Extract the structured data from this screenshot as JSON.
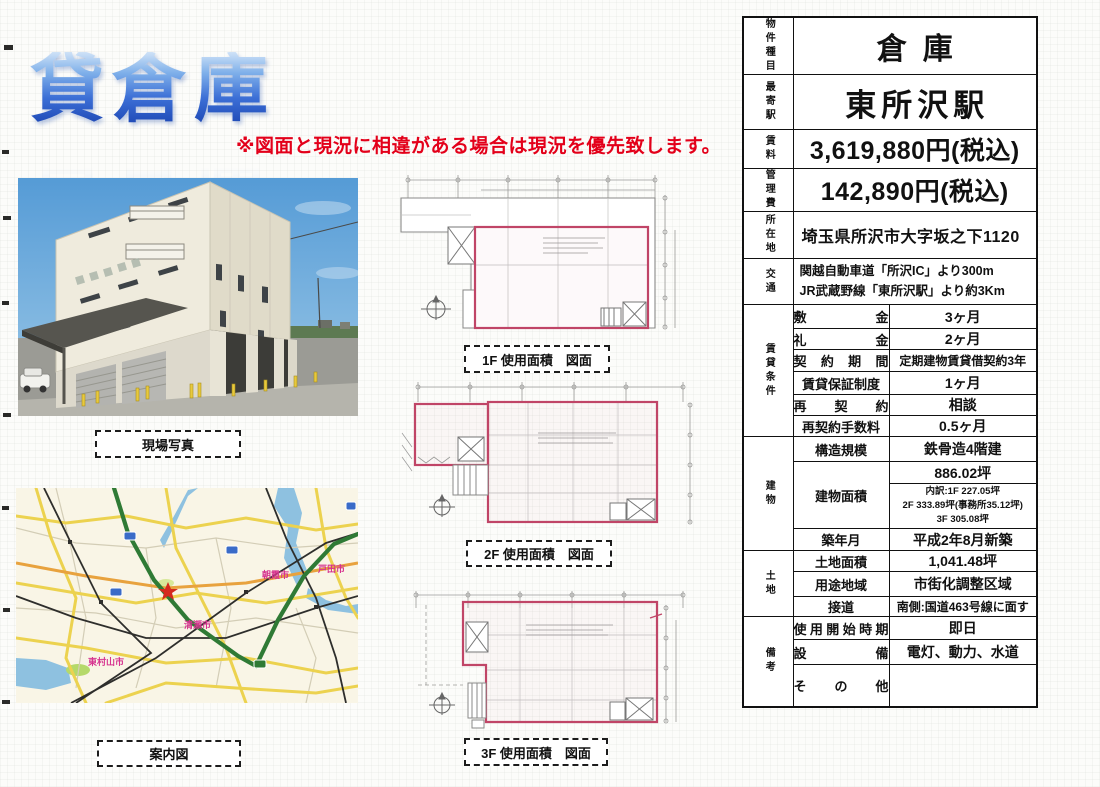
{
  "header": {
    "title": "貸倉庫",
    "disclaimer": "※図面と現況に相違がある場合は現況を優先致します。"
  },
  "captions": {
    "photo": "現場写真",
    "map": "案内図",
    "plan1": "1F 使用面積　図面",
    "plan2": "2F 使用面積　図面",
    "plan3": "3F 使用面積　図面"
  },
  "map_labels": {
    "kiyose": "清瀬市",
    "higashimurayama": "東村山市",
    "asaka": "朝霞市",
    "toda": "戸田市"
  },
  "property_table": {
    "simple_rows": [
      {
        "category": "物件種目",
        "value": "倉庫"
      },
      {
        "category": "最寄駅",
        "value": "東所沢駅"
      },
      {
        "category": "賃料",
        "value": "3,619,880円(税込)"
      },
      {
        "category": "管理費",
        "value": "142,890円(税込)"
      },
      {
        "category": "所在地",
        "value": "埼玉県所沢市大字坂之下1120"
      },
      {
        "category": "交通",
        "value": "関越自動車道「所沢IC」より300m\nJR武蔵野線「東所沢駅」より約3Km"
      }
    ],
    "groups": [
      {
        "category": "賃貸条件",
        "rows": [
          {
            "label": "敷 金",
            "value": "3ヶ月"
          },
          {
            "label": "礼 金",
            "value": "2ヶ月"
          },
          {
            "label": "契 約 期 間",
            "value": "定期建物賃貸借契約3年"
          },
          {
            "label": "賃貸保証制度",
            "value": "1ヶ月"
          },
          {
            "label": "再 契 約",
            "value": "相談"
          },
          {
            "label": "再契約手数料",
            "value": "0.5ヶ月"
          }
        ]
      },
      {
        "category": "建物",
        "rows": [
          {
            "label": "構造規模",
            "value": "鉄骨造4階建"
          },
          {
            "label": "建物面積",
            "value": "886.02坪",
            "sub_value": "内訳:1F 227.05坪\n2F 333.89坪(事務所35.12坪)\n3F 305.08坪"
          },
          {
            "label": "築年月",
            "value": "平成2年8月新築"
          }
        ]
      },
      {
        "category": "土地",
        "rows": [
          {
            "label": "土地面積",
            "value": "1,041.48坪"
          },
          {
            "label": "用途地域",
            "value": "市街化調整区域"
          },
          {
            "label": "接道",
            "value": "南側:国道463号線に面す"
          }
        ]
      },
      {
        "category": "備考",
        "rows": [
          {
            "label": "使用開始時期",
            "value": "即日"
          },
          {
            "label": "設 備",
            "value": "電灯、動力、水道"
          },
          {
            "label": "そ の 他",
            "value": ""
          }
        ]
      }
    ]
  },
  "colors": {
    "title_blue": "#3c6fd6",
    "disclaimer_red": "#e3001a",
    "plan_outline_red": "#c04567",
    "map_expressway_green": "#2f7a35",
    "map_city_label_pink": "#d6338f"
  }
}
